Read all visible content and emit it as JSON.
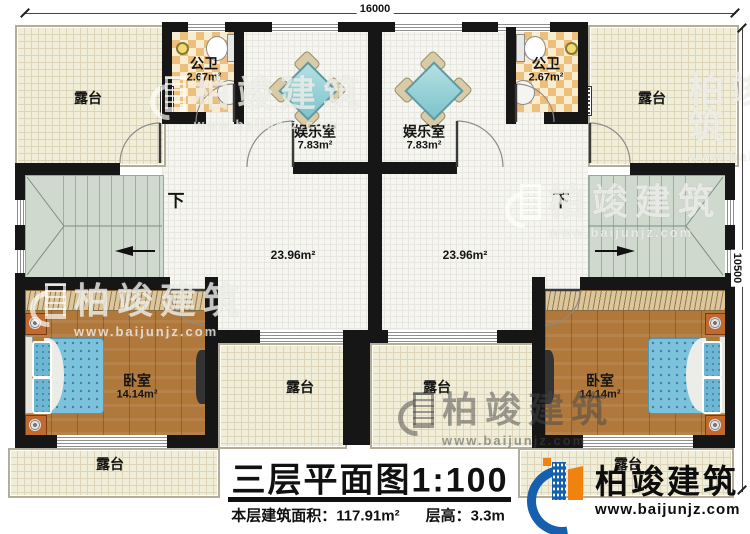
{
  "plan": {
    "title": "三层平面图",
    "scale": "1:100",
    "area_label": "本层建筑面积：",
    "area_value": "117.91m²",
    "height_label": "层高：",
    "height_value": "3.3m"
  },
  "dimensions": {
    "top": "16000",
    "right": "10500"
  },
  "labels": {
    "terrace": "露台",
    "bathroom": "公卫",
    "bathroom_area": "2.67m²",
    "entertainment": "娱乐室",
    "entertainment_area": "7.83m²",
    "hall_area": "23.96m²",
    "bedroom": "卧室",
    "bedroom_area": "14.14m²",
    "stairs_down": "下"
  },
  "brand": {
    "name": "柏竣建筑",
    "website": "www.baijunjz.com"
  },
  "colors": {
    "wall": "#161616",
    "terrace_floor": "#f0edd8",
    "bath_checker": "#ecbf7c",
    "wood_floor": "#b0783a",
    "stairs_floor": "#cfd9ce",
    "mahjong_table": "#7cc4cc",
    "bed": "#7cc2dc",
    "brand_blue": "#1460ae",
    "brand_orange": "#f08210"
  }
}
